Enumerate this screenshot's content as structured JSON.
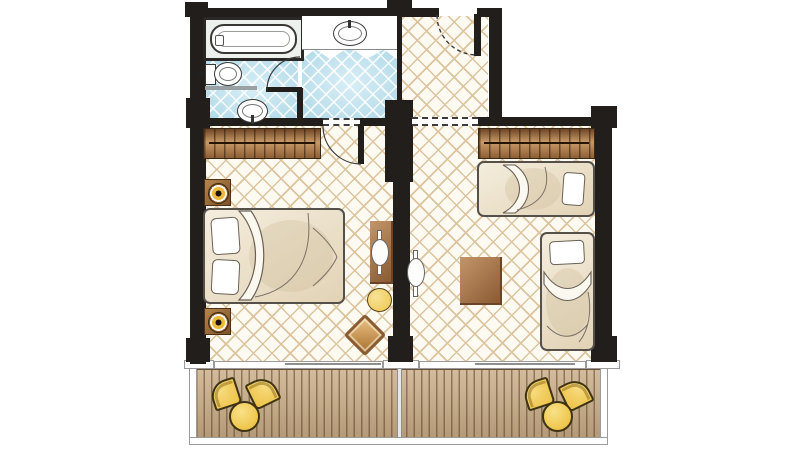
{
  "title": "Hotel guestroom floor plan with two rooms, bathroom and balcony",
  "canvas": {
    "width": 800,
    "height": 450
  },
  "palette": {
    "wall": "#211e1c",
    "floor_beige": "#fdfaf2",
    "lattice_beige": "#dcc49e",
    "floor_blue": "#c9e7f2",
    "deck_wood": "#c9ac86",
    "furniture_wood_dark": "#8a5a33",
    "furniture_wood_light": "#c99a67",
    "bedding": "#f0e8d8",
    "accent_yellow": "#edc145",
    "fixture_white": "#ffffff",
    "outline": "#44403b"
  },
  "rooms": [
    {
      "id": "bathroom",
      "label": "Bathroom",
      "floor": "blue tile"
    },
    {
      "id": "vanity-corridor",
      "label": "Vanity corridor",
      "floor": "blue tile"
    },
    {
      "id": "entry-hall",
      "label": "Entry hall",
      "floor": "beige tile"
    },
    {
      "id": "bedroom",
      "label": "Bedroom",
      "floor": "beige tile"
    },
    {
      "id": "lounge",
      "label": "Second bedroom / lounge",
      "floor": "beige tile"
    },
    {
      "id": "balcony",
      "label": "Balcony with wood deck",
      "floor": "wood deck"
    }
  ],
  "fixtures": {
    "bathtub": "Bathtub",
    "toilet": "Toilet",
    "washbasin": "Washbasin",
    "vanity_sink": "Vanity sink",
    "entry_door": "Entry door (swing)",
    "bathroom_door": "Bathroom door (swing)",
    "bedroom_door": "Bedroom door (swing)",
    "passage_opening": "Open passage",
    "sliding_door_left": "Sliding balcony door",
    "sliding_door_right": "Sliding balcony door",
    "partition": "Half-height partition"
  },
  "furniture": {
    "wardrobe_left": "Wardrobe",
    "wardrobe_right": "Wardrobe",
    "double_bed": "Double bed with pillows",
    "nightstand_top": "Nightstand with lamp",
    "nightstand_bottom": "Nightstand with lamp",
    "desk": "Dressing table",
    "tv_left": "TV / mirror panel",
    "tv_right": "TV / mirror panel",
    "stool": "Round stool",
    "desk_chair": "Chair",
    "single_bed_top": "Single bed",
    "single_bed_right": "Single bed",
    "coffee_table": "Square table",
    "balcony_table_left": "Round balcony table",
    "balcony_chair_left_1": "Balcony chair",
    "balcony_chair_left_2": "Balcony chair",
    "balcony_table_right": "Round balcony table",
    "balcony_chair_right_1": "Balcony chair",
    "balcony_chair_right_2": "Balcony chair"
  }
}
